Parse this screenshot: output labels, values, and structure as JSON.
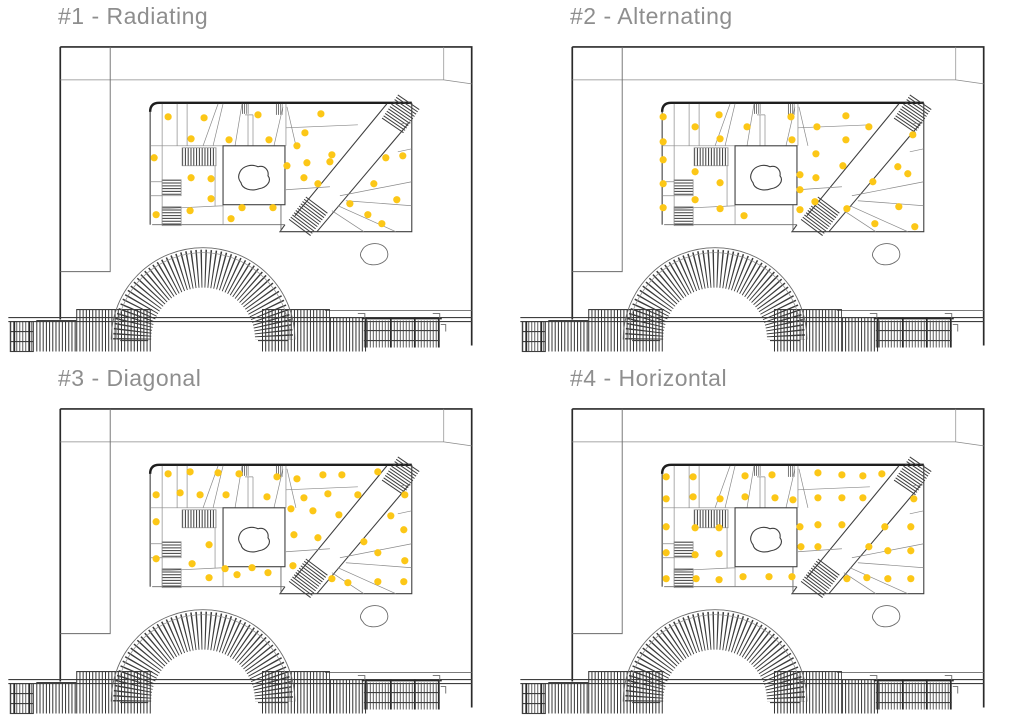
{
  "colors": {
    "dot": "#FCC717",
    "title": "#8E8E8E"
  },
  "panels": [
    {
      "title": "#1 - Radiating",
      "dots": [
        [
          168,
          117
        ],
        [
          204,
          118
        ],
        [
          258,
          115
        ],
        [
          321,
          114
        ],
        [
          191,
          139
        ],
        [
          229,
          140
        ],
        [
          269,
          140
        ],
        [
          305,
          133
        ],
        [
          297,
          146
        ],
        [
          154,
          158
        ],
        [
          332,
          155
        ],
        [
          386,
          158
        ],
        [
          403,
          156
        ],
        [
          287,
          166
        ],
        [
          307,
          163
        ],
        [
          330,
          162
        ],
        [
          191,
          178
        ],
        [
          211,
          179
        ],
        [
          304,
          178
        ],
        [
          318,
          184
        ],
        [
          374,
          184
        ],
        [
          397,
          200
        ],
        [
          211,
          199
        ],
        [
          350,
          204
        ],
        [
          242,
          208
        ],
        [
          273,
          208
        ],
        [
          190,
          211
        ],
        [
          368,
          215
        ],
        [
          156,
          215
        ],
        [
          231,
          219
        ],
        [
          382,
          224
        ]
      ]
    },
    {
      "title": "#2 - Alternating",
      "dots": [
        [
          151,
          117
        ],
        [
          183,
          127
        ],
        [
          207,
          115
        ],
        [
          235,
          127
        ],
        [
          279,
          117
        ],
        [
          334,
          116
        ],
        [
          151,
          142
        ],
        [
          208,
          139
        ],
        [
          280,
          140
        ],
        [
          305,
          127
        ],
        [
          357,
          127
        ],
        [
          334,
          140
        ],
        [
          401,
          135
        ],
        [
          151,
          160
        ],
        [
          304,
          154
        ],
        [
          386,
          167
        ],
        [
          183,
          172
        ],
        [
          208,
          183
        ],
        [
          288,
          175
        ],
        [
          304,
          178
        ],
        [
          331,
          166
        ],
        [
          361,
          182
        ],
        [
          396,
          174
        ],
        [
          151,
          184
        ],
        [
          288,
          190
        ],
        [
          183,
          200
        ],
        [
          208,
          209
        ],
        [
          288,
          210
        ],
        [
          303,
          202
        ],
        [
          335,
          209
        ],
        [
          387,
          207
        ],
        [
          151,
          208
        ],
        [
          232,
          216
        ],
        [
          363,
          224
        ],
        [
          403,
          227
        ]
      ]
    },
    {
      "title": "#3 - Diagonal",
      "dots": [
        [
          168,
          112
        ],
        [
          190,
          110
        ],
        [
          218,
          111
        ],
        [
          239,
          112
        ],
        [
          277,
          115
        ],
        [
          297,
          117
        ],
        [
          323,
          113
        ],
        [
          342,
          113
        ],
        [
          378,
          110
        ],
        [
          156,
          133
        ],
        [
          180,
          131
        ],
        [
          200,
          133
        ],
        [
          226,
          133
        ],
        [
          267,
          135
        ],
        [
          304,
          136
        ],
        [
          328,
          132
        ],
        [
          358,
          133
        ],
        [
          405,
          133
        ],
        [
          156,
          160
        ],
        [
          291,
          147
        ],
        [
          313,
          149
        ],
        [
          339,
          153
        ],
        [
          391,
          154
        ],
        [
          209,
          183
        ],
        [
          294,
          173
        ],
        [
          318,
          176
        ],
        [
          364,
          180
        ],
        [
          404,
          168
        ],
        [
          156,
          197
        ],
        [
          192,
          202
        ],
        [
          225,
          207
        ],
        [
          252,
          206
        ],
        [
          268,
          211
        ],
        [
          293,
          204
        ],
        [
          378,
          191
        ],
        [
          405,
          199
        ],
        [
          209,
          216
        ],
        [
          237,
          213
        ],
        [
          332,
          217
        ],
        [
          348,
          221
        ],
        [
          378,
          220
        ],
        [
          404,
          220
        ]
      ]
    },
    {
      "title": "#4 - Horizontal",
      "dots": [
        [
          154,
          115
        ],
        [
          181,
          115
        ],
        [
          233,
          114
        ],
        [
          260,
          113
        ],
        [
          306,
          111
        ],
        [
          330,
          113
        ],
        [
          351,
          114
        ],
        [
          370,
          112
        ],
        [
          154,
          137
        ],
        [
          181,
          135
        ],
        [
          208,
          137
        ],
        [
          233,
          135
        ],
        [
          263,
          136
        ],
        [
          281,
          138
        ],
        [
          306,
          136
        ],
        [
          330,
          136
        ],
        [
          351,
          136
        ],
        [
          402,
          137
        ],
        [
          154,
          165
        ],
        [
          183,
          166
        ],
        [
          207,
          166
        ],
        [
          288,
          165
        ],
        [
          306,
          163
        ],
        [
          330,
          163
        ],
        [
          373,
          165
        ],
        [
          399,
          165
        ],
        [
          154,
          191
        ],
        [
          183,
          193
        ],
        [
          207,
          192
        ],
        [
          289,
          185
        ],
        [
          306,
          185
        ],
        [
          357,
          185
        ],
        [
          376,
          189
        ],
        [
          399,
          189
        ],
        [
          154,
          217
        ],
        [
          184,
          217
        ],
        [
          207,
          218
        ],
        [
          231,
          215
        ],
        [
          257,
          215
        ],
        [
          280,
          215
        ],
        [
          335,
          217
        ],
        [
          355,
          216
        ],
        [
          376,
          217
        ],
        [
          399,
          217
        ]
      ]
    }
  ]
}
